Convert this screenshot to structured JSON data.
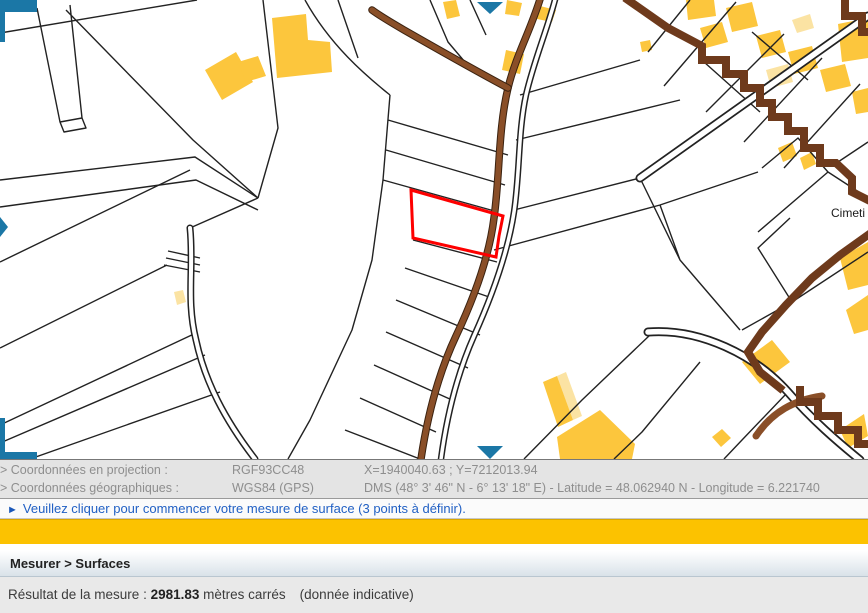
{
  "map": {
    "cimetiere_label": "Cimeti",
    "colors": {
      "building": "#fcc63d",
      "building_light": "#fbe3a3",
      "road_brown": "#8a4f28",
      "boundary_brown": "#6e3a1c",
      "parcel_line": "#222222",
      "selection_red": "#fe0000",
      "pan_control": "#1b77a6"
    }
  },
  "coordinates_panel": {
    "projection_label": "> Coordonnées en projection :",
    "projection_system": "RGF93CC48",
    "projection_value": "X=1940040.63 ; Y=7212013.94",
    "geographic_label": "> Coordonnées géographiques :",
    "geographic_system": "WGS84 (GPS)",
    "geographic_value": "DMS (48° 3' 46\" N - 6° 13' 18\" E) - Latitude = 48.062940 N - Longitude = 6.221740"
  },
  "message_bar": {
    "arrow": "►",
    "text": "Veuillez cliquer pour commencer votre mesure de surface (3 points à définir)."
  },
  "breadcrumb": {
    "text": "Mesurer > Surfaces"
  },
  "result": {
    "label": "Résultat de la mesure : ",
    "value": "2981.83",
    "unit": " mètres carrés",
    "note": "(donnée indicative)"
  }
}
